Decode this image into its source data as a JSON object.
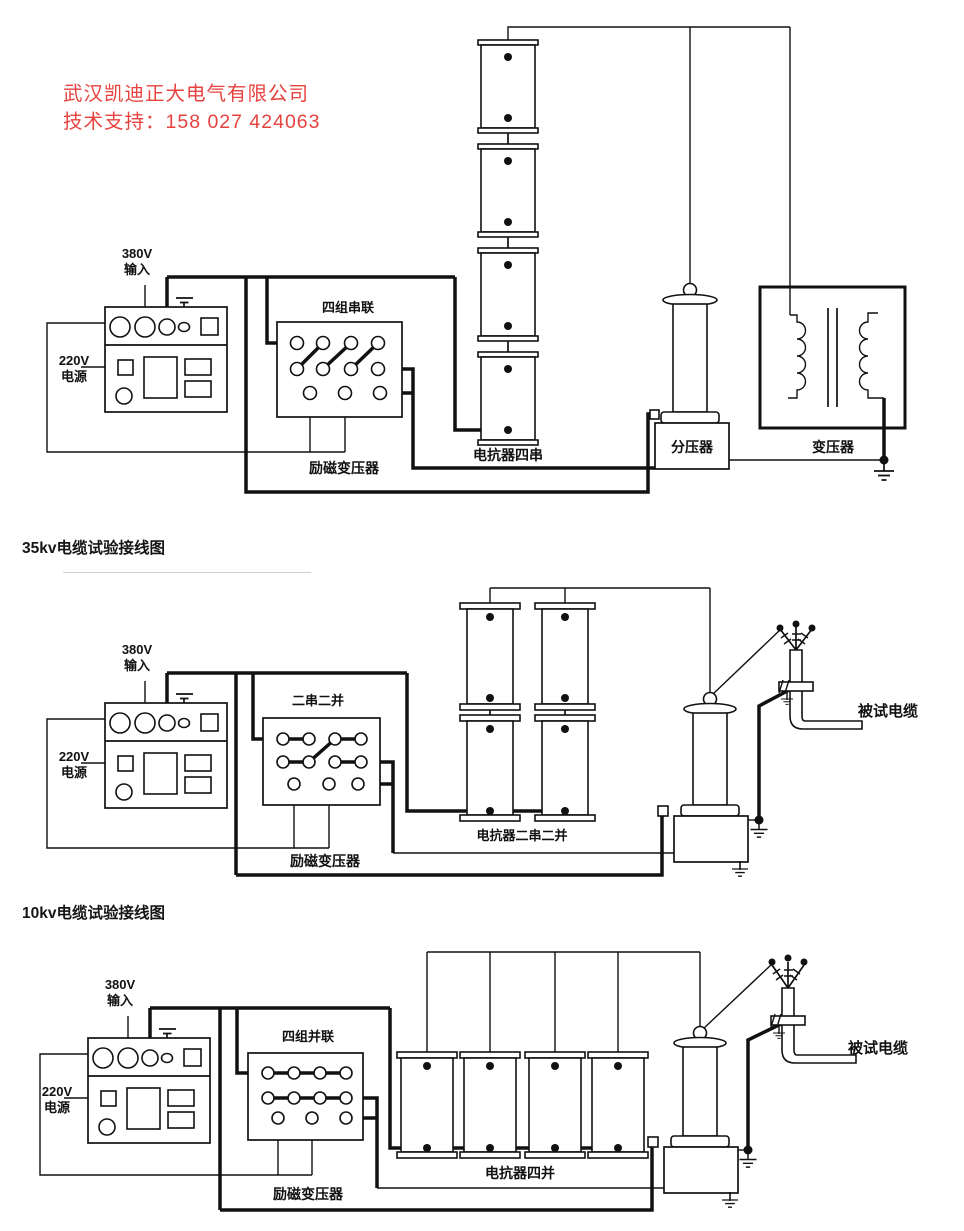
{
  "header": {
    "company": "武汉凯迪正大电气有限公司",
    "support": "技术支持：158 027 424063",
    "accent_color": "#e8423e"
  },
  "common": {
    "input_l1": "380V",
    "input_l2": "输入",
    "power_l1": "220V",
    "power_l2": "电源",
    "excitation": "励磁变压器",
    "cable": "被试电缆"
  },
  "d1": {
    "switch": "四组串联",
    "reactor": "电抗器四串",
    "divider": "分压器",
    "transformer": "变压器"
  },
  "d2": {
    "heading": "35kv电缆试验接线图",
    "switch": "二串二并",
    "reactor": "电抗器二串二并"
  },
  "d3": {
    "heading": "10kv电缆试验接线图",
    "switch": "四组并联",
    "reactor": "电抗器四并"
  }
}
